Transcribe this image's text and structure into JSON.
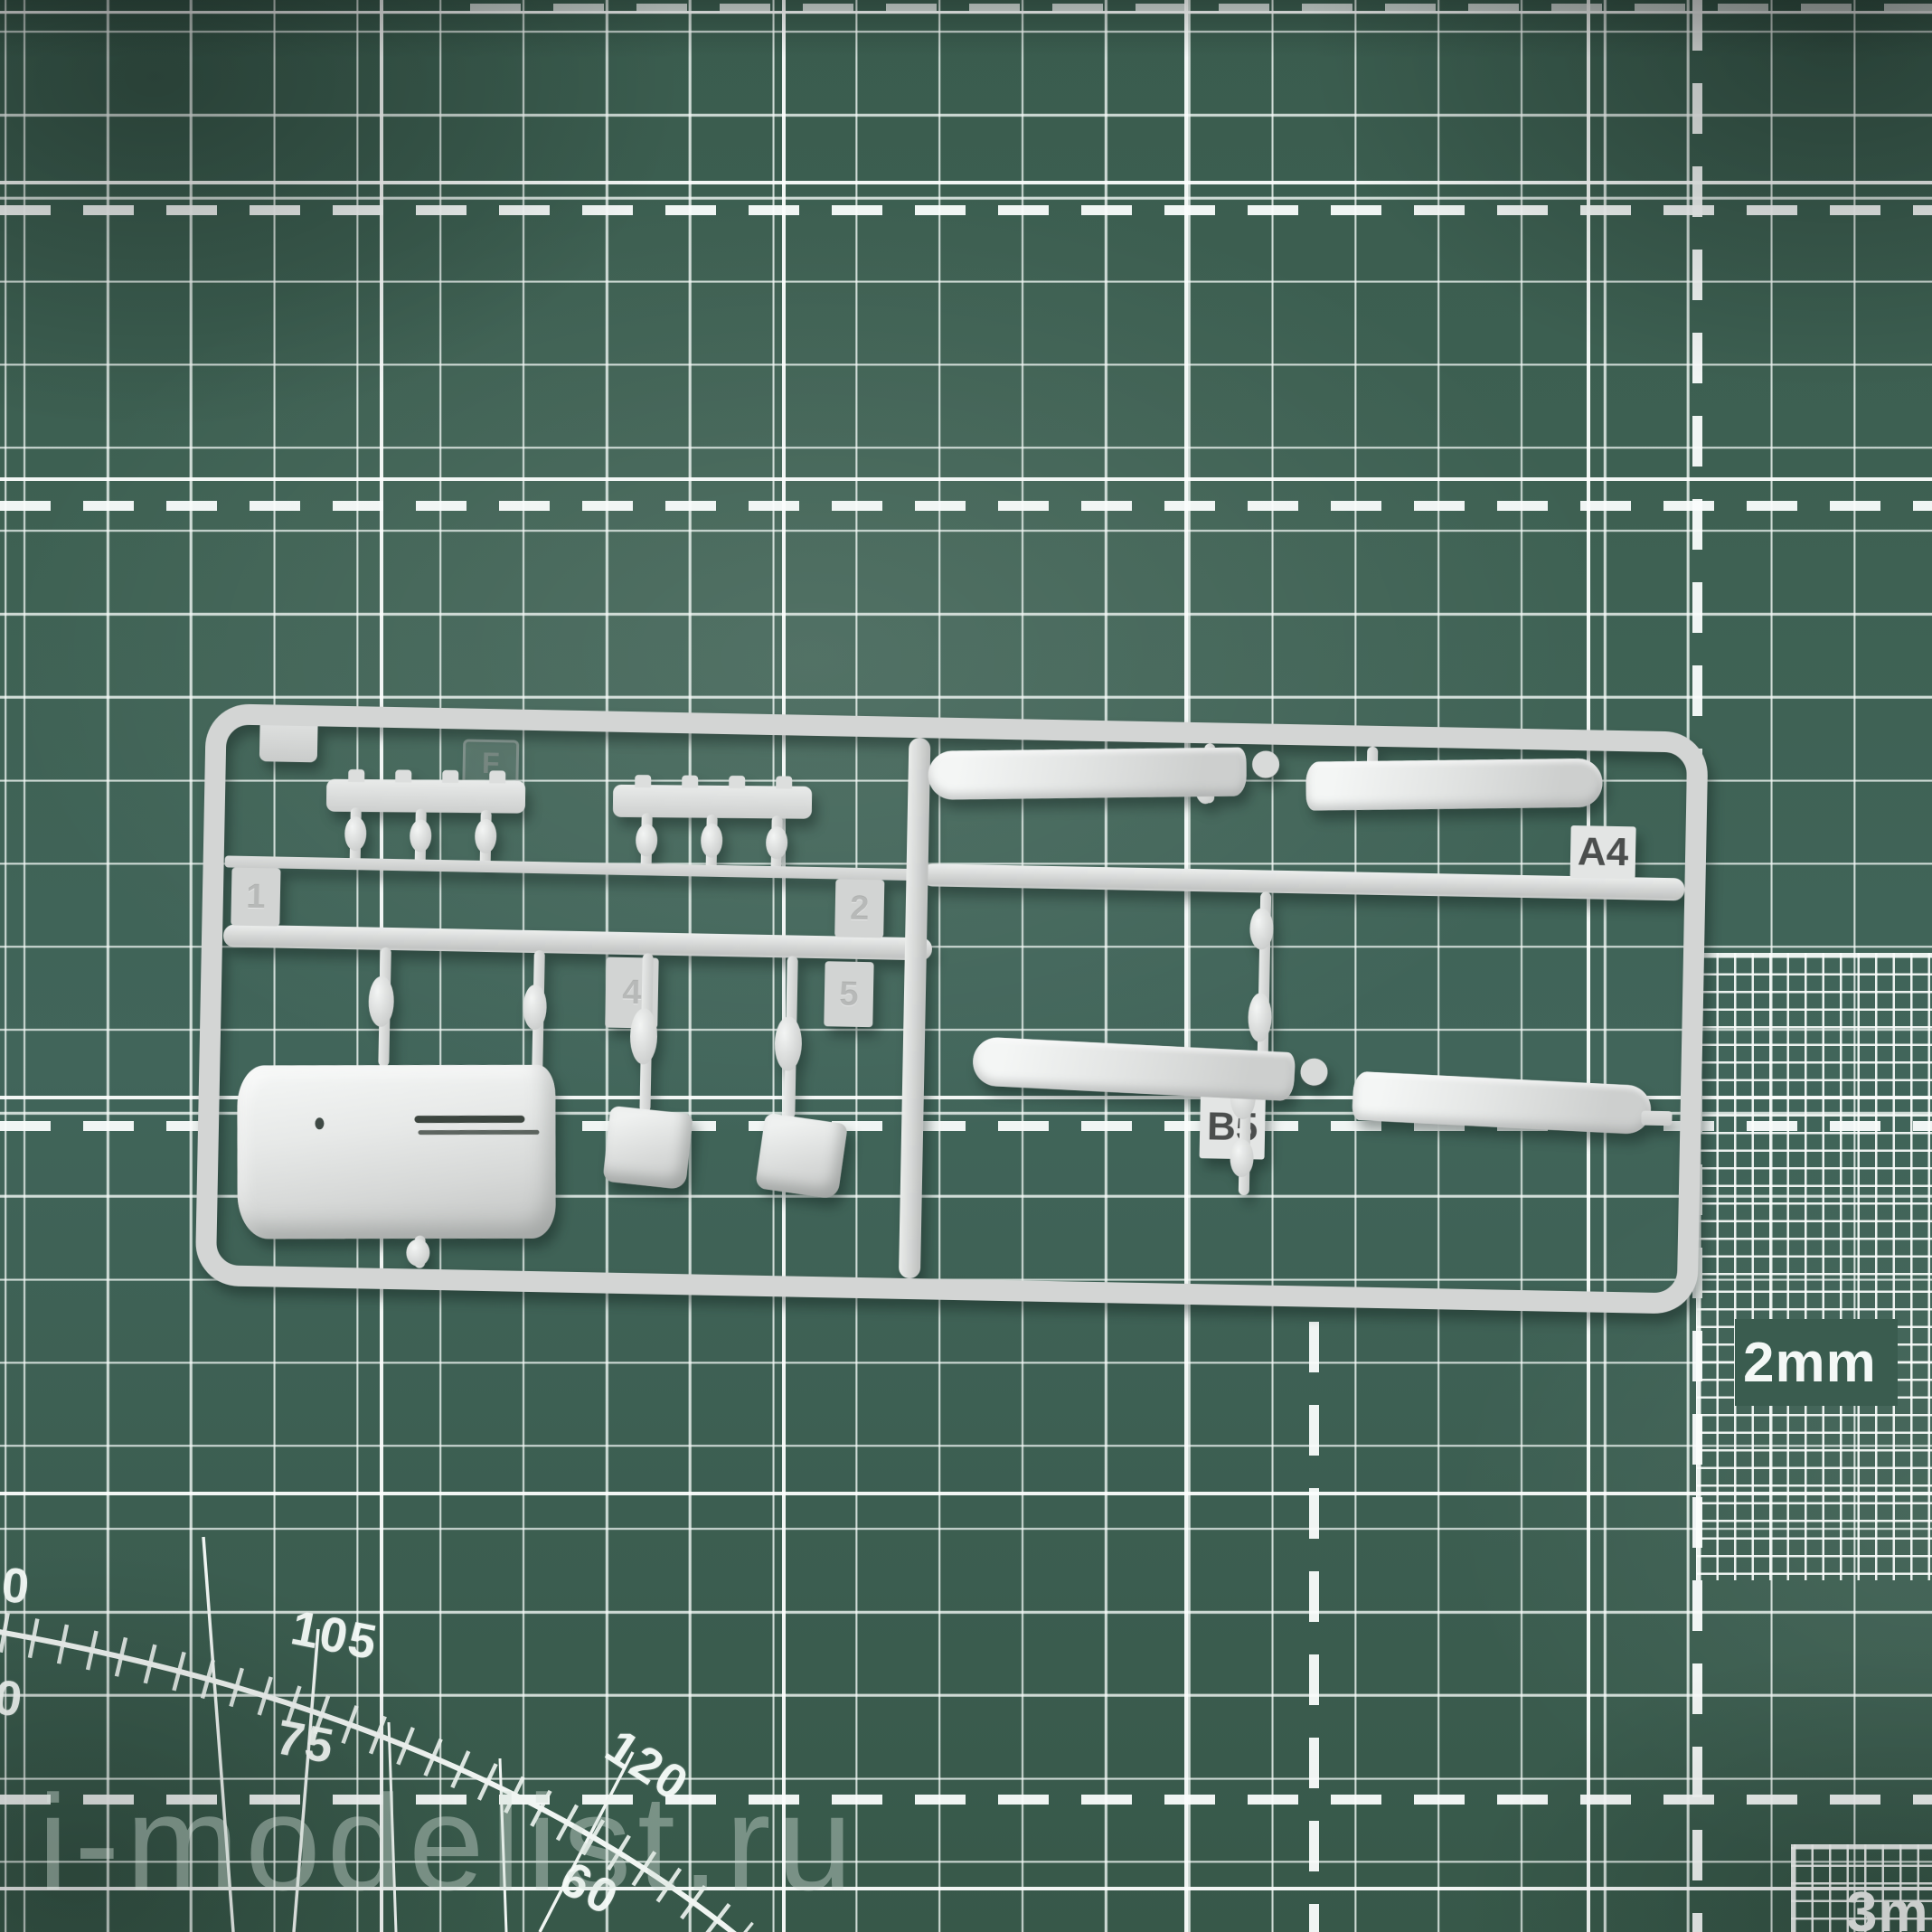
{
  "watermark": {
    "text": "i-modelist.ru"
  },
  "mat": {
    "fine_grid_right_label": "2mm",
    "fine_grid_bottom_label": "3mm",
    "protractor": {
      "outer_labels": [
        "90",
        "105",
        "120"
      ],
      "inner_labels": [
        "90",
        "75",
        "60"
      ]
    }
  },
  "sprue": {
    "frame_mark": "F",
    "gate_label_a": "A4",
    "gate_label_b": "B5",
    "number_tabs": [
      "1",
      "2",
      "4",
      "5"
    ]
  }
}
